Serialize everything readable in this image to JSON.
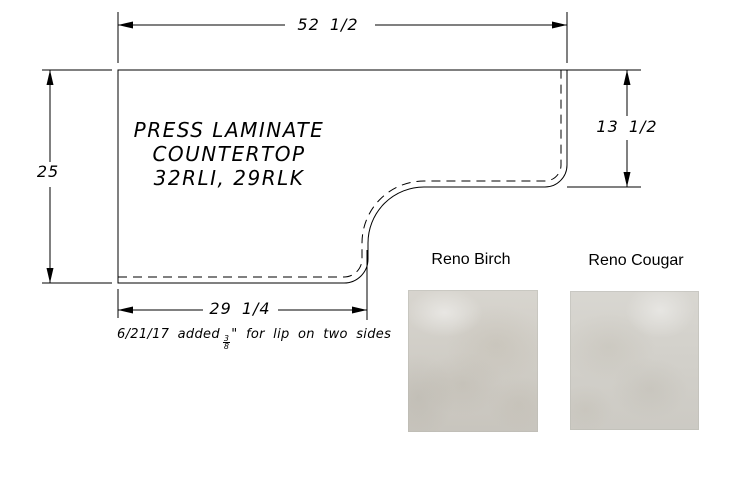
{
  "drawing": {
    "title_lines": [
      "PRESS LAMINATE",
      "COUNTERTOP",
      "32RLI, 29RLK"
    ],
    "dimensions": {
      "top": "52 1/2",
      "left": "25",
      "right": "13 1/2",
      "bottom": "29 1/4"
    },
    "note": {
      "prefix": "6/21/17 added",
      "fraction_numerator": "3",
      "fraction_denominator": "8",
      "suffix": "\" for lip on two sides"
    },
    "line_color": "#000000"
  },
  "swatches": [
    {
      "label": "Reno Birch",
      "base_color": "#d3d0c9"
    },
    {
      "label": "Reno Cougar",
      "base_color": "#d5d3cd"
    }
  ]
}
